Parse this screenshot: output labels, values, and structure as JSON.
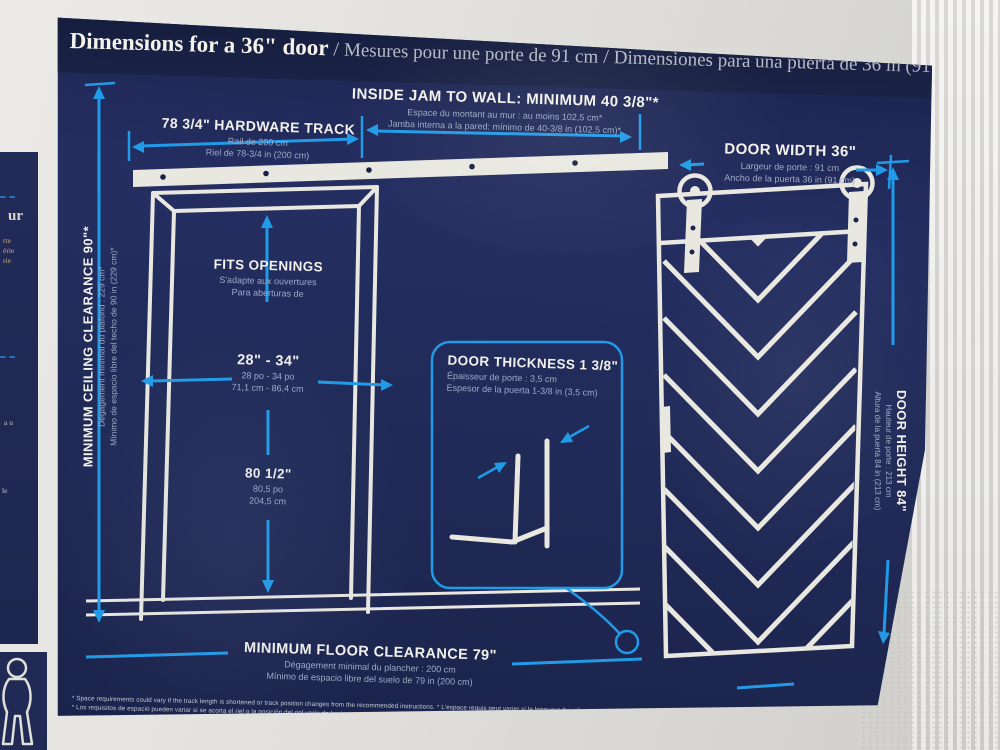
{
  "title": {
    "en": "Dimensions for a 36\" door",
    "sep": " / ",
    "fr": "Mesures pour une porte de 91 cm",
    "es": "Dimensiones para una puerta de 36 in (91 cm)"
  },
  "labels": {
    "inside_jam": {
      "en": "INSIDE JAM TO WALL: MINIMUM 40 3/8\"*",
      "fr": "Espace du montant au mur : au moins 102,5 cm*",
      "es": "Jamba interna a la pared: mínimo de 40-3/8 in (102,5 cm)*"
    },
    "hardware_track": {
      "en": "78 3/4\" HARDWARE TRACK",
      "fr": "Rail de 200 cm",
      "es": "Riel de 78-3/4 in (200 cm)"
    },
    "door_width": {
      "en": "DOOR WIDTH 36\"",
      "fr": "Largeur de porte : 91 cm",
      "es": "Ancho de la puerta 36 in (91 cm)"
    },
    "ceiling_clearance": {
      "en": "MINIMUM CEILING CLEARANCE 90\"*",
      "fr": "Dégagement minimal du plafond : 229 cm*",
      "es": "Mínimo de espacio libre del techo de 90 in (229 cm)*"
    },
    "fits_openings": {
      "en": "FITS OPENINGS",
      "fr": "S'adapte aux ouvertures",
      "es": "Para aberturas de"
    },
    "opening_range": {
      "en": "28\" - 34\"",
      "fr": "28 po - 34 po",
      "es": "71,1 cm - 86,4 cm"
    },
    "door_thickness": {
      "en": "DOOR THICKNESS 1 3/8\"",
      "fr": "Épaisseur de porte : 3,5 cm",
      "es": "Espesor de la puerta 1-3/8 in (3,5 cm)"
    },
    "opening_height": {
      "en": "80 1/2\"",
      "fr": "80,5 po",
      "es": "204,5 cm"
    },
    "door_height": {
      "en": "DOOR HEIGHT 84\"",
      "fr": "Hauteur de porte : 213 cm",
      "es": "Altura de la puerta 84 in (213 cm)"
    },
    "floor_clearance": {
      "en": "MINIMUM FLOOR CLEARANCE 79\"",
      "fr": "Dégagement minimal du plancher : 200 cm",
      "es": "Mínimo de espacio libre del suelo de 79 in (200 cm)"
    }
  },
  "footnote": {
    "line1": "* Space requirements could vary if the track length is shortened or track position changes from the recommended instructions. * L'espace requis peut varier si la longueur du rail est raccourcie ou si la position du rail change par rapport aux instructions recommandées.",
    "line2": "* Los requisitos de espacio pueden variar si se acorta el riel o la posición del riel varía de las instrucciones recomendadas."
  },
  "adjacent_panel": {
    "fragments": [
      "ur",
      "rte",
      "érie",
      "rie",
      "a u",
      "le"
    ]
  },
  "colors": {
    "panel_navy": "#222c5c",
    "title_band": "#1a2247",
    "arrow_blue": "#219be7",
    "line_white": "#e9e8e0",
    "subtext": "#9ea9c6"
  }
}
